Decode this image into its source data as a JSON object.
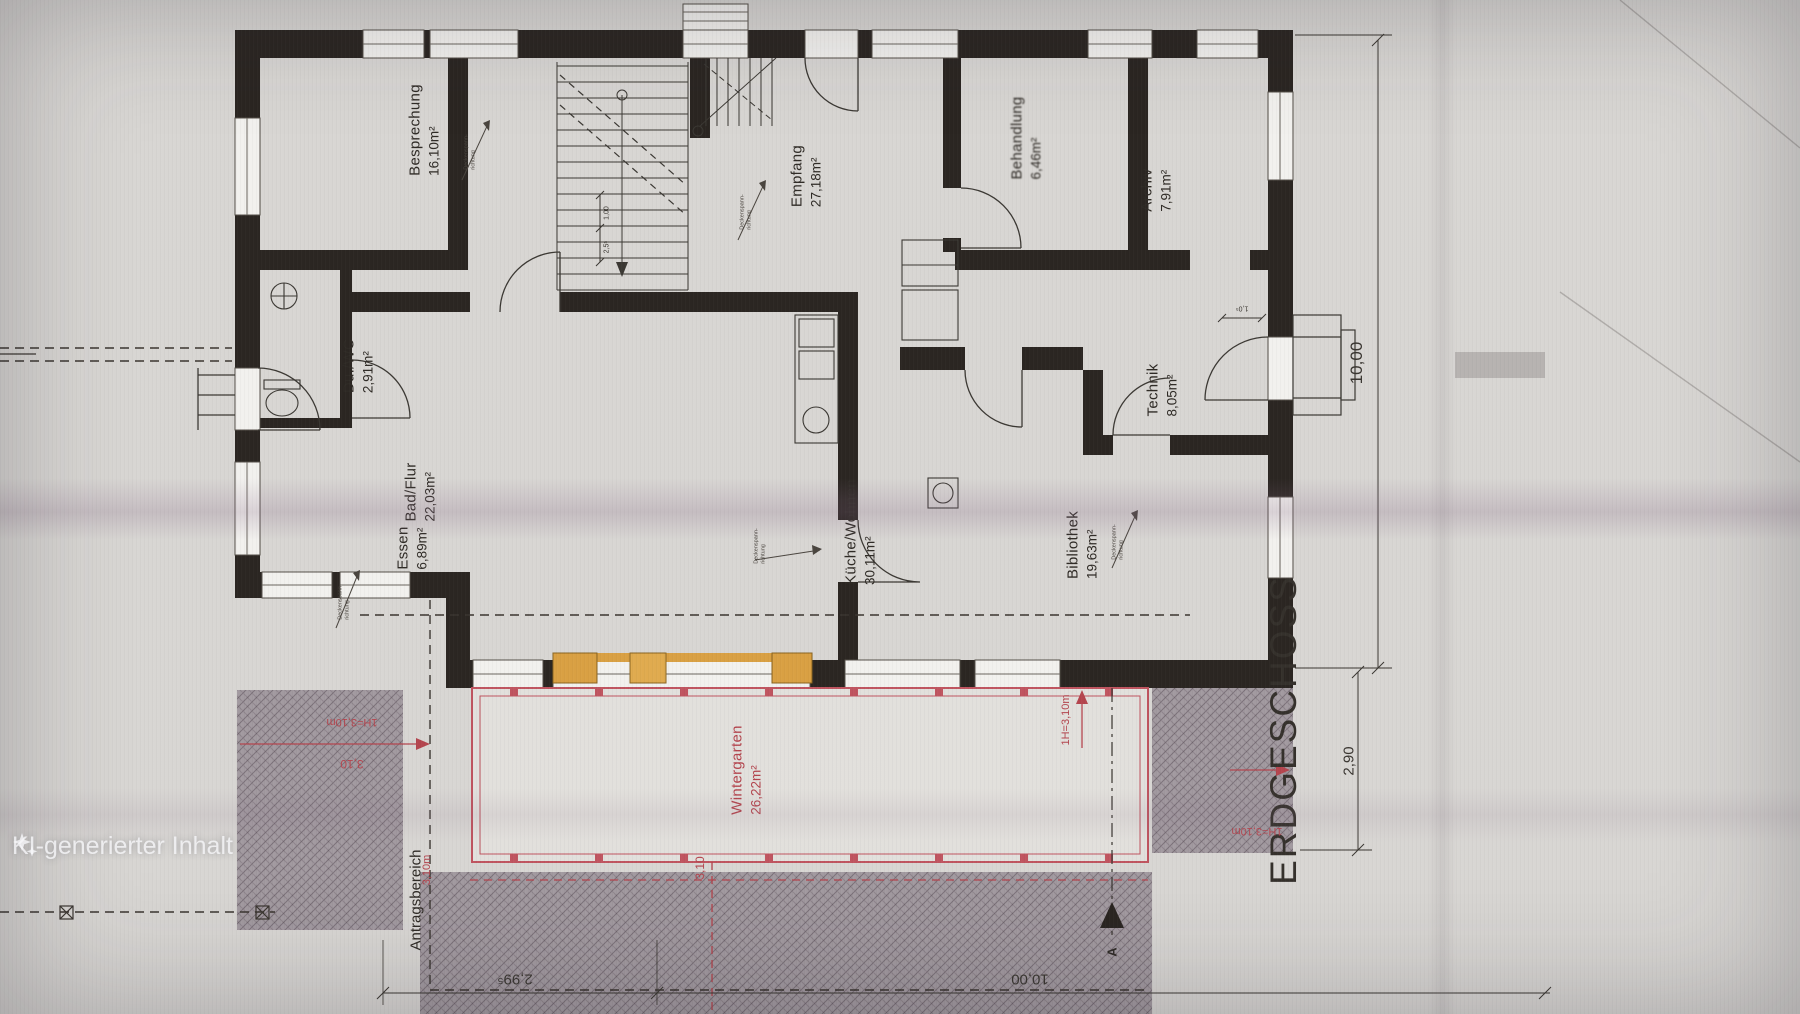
{
  "meta": {
    "title": "ERDGESCHOSS",
    "watermark": "KI-generierter Inhalt"
  },
  "rooms": {
    "besprechung": {
      "name": "Besprechung",
      "area": "16,10m²"
    },
    "empfang": {
      "name": "Empfang",
      "area": "27,18m²"
    },
    "behandlung": {
      "name": "Behandlung",
      "area": "6,46m²"
    },
    "archiv": {
      "name": "Archiv",
      "area": "7,91m²"
    },
    "duwc": {
      "name": "Du./WC",
      "area": "2,91m²"
    },
    "badflur": {
      "name": "Bad/Flur",
      "area": "22,03m²"
    },
    "essen": {
      "name": "Essen",
      "area": "6,89m²"
    },
    "kueche": {
      "name": "Küche/Wohnen",
      "area": "30,11m²"
    },
    "bibliothek": {
      "name": "Bibliothek",
      "area": "19,63m²"
    },
    "technik": {
      "name": "Technik",
      "area": "8,05m²"
    },
    "wintergarten": {
      "name": "Wintergarten",
      "area": "26,22m²"
    }
  },
  "zones": {
    "antragsbereich": "Antragsbereich"
  },
  "dims": {
    "right_total": "10,00",
    "right_lower": "2,90",
    "bottom_left": "2,99⁵",
    "bottom_mid": "10,00",
    "red_h_top": "1H=3,10m",
    "red_h_val": "3,10",
    "red_v_left": "3,10m",
    "red_v_mid": "3,10",
    "red_v_right": "1H=3,10m",
    "red_bottom_right": "1H=3,10m",
    "stair_dim1": "1,00",
    "stair_dim2": "2,5⁵",
    "door_dim": "1,0⁵"
  },
  "annotations": {
    "ceiling_line1": "Deckenspann-",
    "ceiling_line2": "richtung",
    "section": "A"
  },
  "colors": {
    "wall": "#2b2622",
    "red": "#b4454e",
    "orange": "#d9a043",
    "gray": "#a29aa0"
  }
}
